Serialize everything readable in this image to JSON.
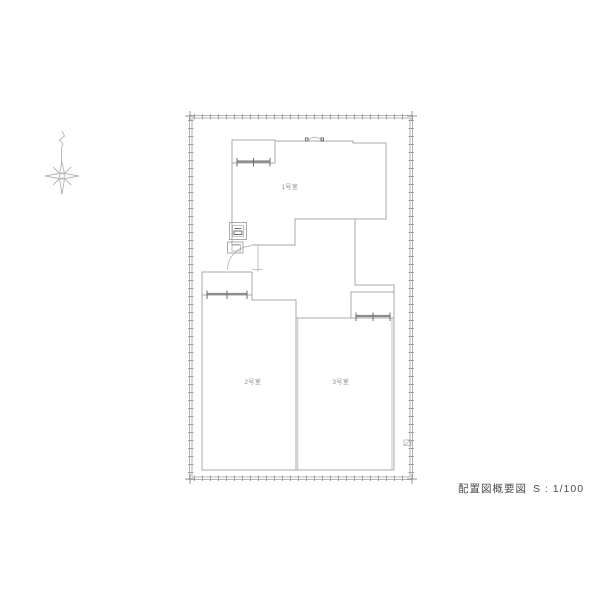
{
  "drawing": {
    "rooms": [
      {
        "label": "1号室"
      },
      {
        "label": "2号室"
      },
      {
        "label": "3号室"
      }
    ],
    "title_block": {
      "title": "配置図概要図",
      "scale": "S : 1/100"
    }
  },
  "icons": {
    "compass": "north-arrow-icon"
  },
  "colors": {
    "bg": "#ffffff",
    "line": "#a9a9a9",
    "line-strong": "#8c8c8c",
    "tick": "#6e6e6e",
    "fence": "#a0a0a0",
    "label": "#8a8a8a",
    "title-text": "#4c4c4c",
    "compass": "#b5b5b5"
  }
}
